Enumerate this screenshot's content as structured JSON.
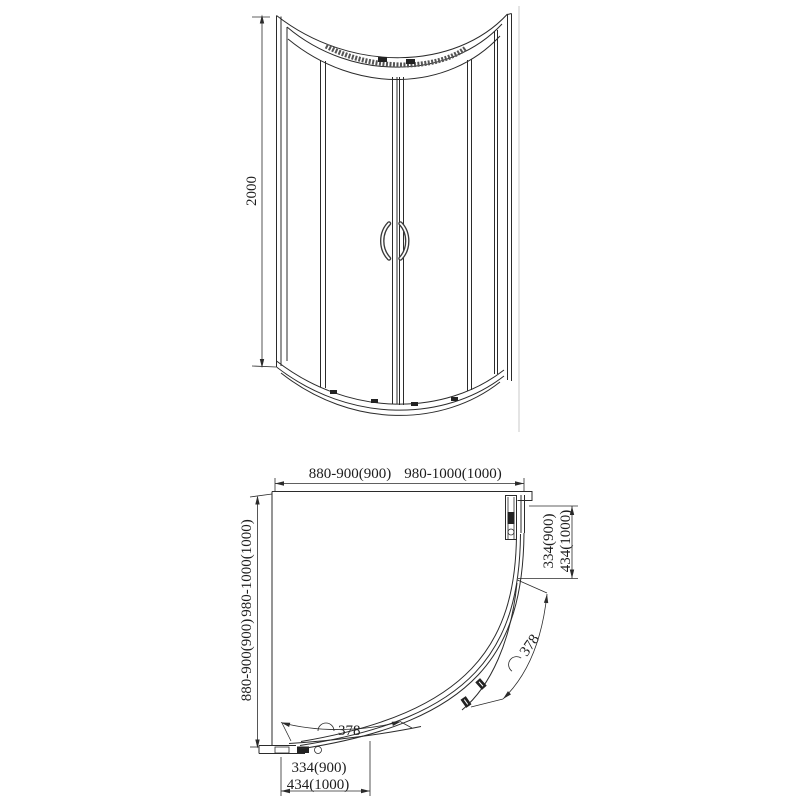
{
  "drawing": {
    "type": "shower-enclosure-technical-drawing",
    "colors": {
      "line": "#2b2b2b",
      "projection_line": "#c9c9c9",
      "background": "#ffffff"
    },
    "elevation": {
      "height_dim": "2000"
    },
    "plan": {
      "top_dim_a": "880-900(900)",
      "top_dim_b": "980-1000(1000)",
      "left_dim_a": "880-900(900)",
      "left_dim_b": "980-1000(1000)",
      "right_dim_a": "334(900)",
      "right_dim_b": "434(1000)",
      "bottom_dim_a": "334(900)",
      "bottom_dim_b": "434(1000)",
      "right_door_arc_dim": "378",
      "bottom_door_arc_dim": "378"
    }
  }
}
